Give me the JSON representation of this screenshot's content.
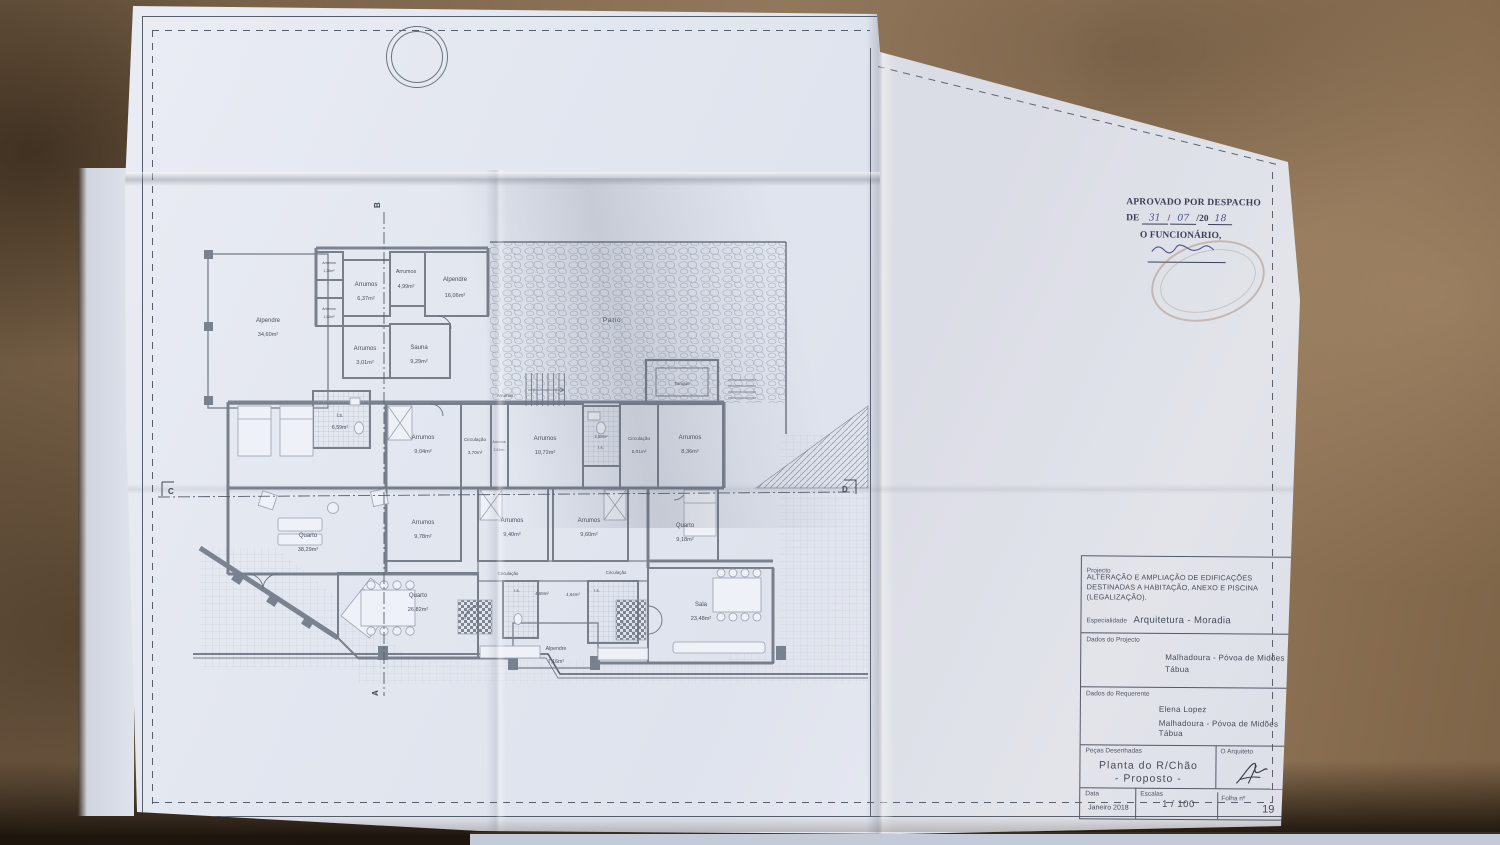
{
  "stamp": {
    "approved_line": "APROVADO POR DESPACHO",
    "de_label": "DE",
    "date_part1": "31",
    "date_part2": "07",
    "date_part3": "/20",
    "date_part4": "18",
    "official_label": "O FUNCIONÁRIO,"
  },
  "title_block": {
    "projecto_label": "Projecto",
    "projecto_text": "ALTERAÇÃO E AMPLIAÇÃO DE EDIFICAÇÕES DESTINADAS A HABITAÇÃO, ANEXO E PISCINA (LEGALIZAÇÃO).",
    "especialidade_label": "Especialidade",
    "especialidade_value": "Arquitetura - Moradia",
    "dados_projecto_label": "Dados do Projecto",
    "dados_projecto_line1": "Malhadoura - Póvoa de Midões",
    "dados_projecto_line2": "Tábua",
    "dados_requerente_label": "Dados do Requerente",
    "requerente_nome": "Elena Lopez",
    "requerente_line1": "Malhadoura - Póvoa de Midões",
    "requerente_line2": "Tábua",
    "pecas_label": "Peças Desenhadas",
    "pecas_line1": "Planta do R/Chão",
    "pecas_line2": "- Proposto -",
    "arquiteto_label": "O Arquiteto",
    "data_label": "Data",
    "data_value": "Janeiro 2018",
    "escalas_label": "Escalas",
    "escalas_value": "1 / 100",
    "folha_label": "Folha nº",
    "folha_value": "19"
  },
  "plan": {
    "patio": "Pátio",
    "tanque": "Tanque",
    "markers": {
      "a": "A",
      "b": "B",
      "c": "C",
      "d": "D"
    },
    "rooms": [
      {
        "name": "Alpendre",
        "area": "34,60m²"
      },
      {
        "name": "Arrumos",
        "area": "1,26m²"
      },
      {
        "name": "Arrumos",
        "area": "6,37m²"
      },
      {
        "name": "Arrumos",
        "area": "4,99m²"
      },
      {
        "name": "Alpendre",
        "area": "16,06m²"
      },
      {
        "name": "Arrumos",
        "area": "1,52m²"
      },
      {
        "name": "Arrumos",
        "area": "3,01m²"
      },
      {
        "name": "Sauna",
        "area": "9,29m²"
      },
      {
        "name": "Arrumos",
        "area": ""
      },
      {
        "name": "I.s.",
        "area": "6,59m²"
      },
      {
        "name": "Arrumos",
        "area": "9,04m²"
      },
      {
        "name": "Circulação",
        "area": "3,70m²"
      },
      {
        "name": "Arrumos",
        "area": "2,61m²"
      },
      {
        "name": "Arrumos",
        "area": "10,72m²"
      },
      {
        "name": "I.s.",
        "area": "2,58m²"
      },
      {
        "name": "Circulação",
        "area": "5,01m²"
      },
      {
        "name": "Arrumos",
        "area": "8,36m²"
      },
      {
        "name": "Quarto",
        "area": "38,29m²"
      },
      {
        "name": "Arrumos",
        "area": "9,78m²"
      },
      {
        "name": "Arrumos",
        "area": "9,40m²"
      },
      {
        "name": "Arrumos",
        "area": "9,60m²"
      },
      {
        "name": "Quarto",
        "area": "9,18m²"
      },
      {
        "name": "Circulação",
        "area": ""
      },
      {
        "name": "I.s.",
        "area": "4,59m²"
      },
      {
        "name": "I.s.",
        "area": "4,64m²"
      },
      {
        "name": "Circulação",
        "area": ""
      },
      {
        "name": "Quarto",
        "area": "26,82m²"
      },
      {
        "name": "Sala",
        "area": "23,48m²"
      },
      {
        "name": "Alpendre",
        "area": "7,16m²"
      }
    ]
  },
  "colors": {
    "paper": "#e4e8f1",
    "leather": "#8a7156",
    "plan_line": "#5d6575",
    "wall": "#7d838f",
    "stamp_ink": "#343b52",
    "hand_ink": "#44508a"
  }
}
